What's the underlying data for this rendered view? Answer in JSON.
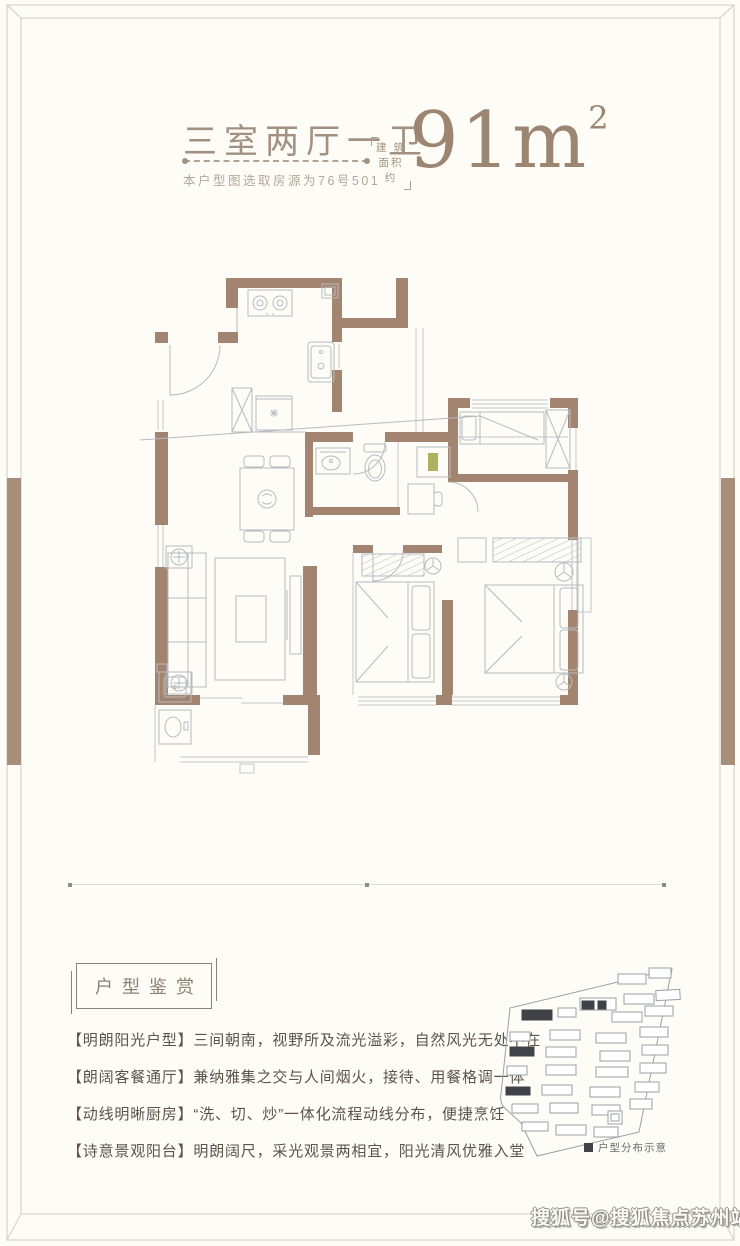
{
  "page": {
    "background": "#fdfcf7",
    "frame_color": "#d8d4ca",
    "accent_color": "#a68e7a"
  },
  "header": {
    "title": "三室两厅一卫",
    "subtitle": "本户型图选取房源为76号501",
    "area_prefix_line1": "建 筑",
    "area_prefix_line2": "面积约",
    "area_value": "91m",
    "area_superscript": "2"
  },
  "floor_plan": {
    "wall_color": "#a28470",
    "furniture_line_color": "#b7bbc0",
    "fixture_icons": [
      "stove-icon",
      "kitchen-sink-icon",
      "fridge-icon",
      "dining-table-icon",
      "washbasin-icon",
      "toilet-icon",
      "bed-icon",
      "wardrobe-icon",
      "sofa-icon",
      "coffee-table-icon",
      "tv-cabinet-icon",
      "washing-machine-icon",
      "laundry-sink-icon",
      "air-conditioner-icon",
      "door-arc-icon",
      "window-icon"
    ]
  },
  "appreciation": {
    "section_title": "户型鉴赏",
    "items": [
      "【明朗阳光户型】三间朝南，视野所及流光溢彩，自然风光无处不在",
      "【朗阔客餐通厅】兼纳雅集之交与人间烟火，接待、用餐格调一体",
      "【动线明晰厨房】“洗、切、炒”一体化流程动线分布，便捷烹饪",
      "【诗意景观阳台】明朗阔尺，采光观景两相宜，阳光清风优雅入堂"
    ]
  },
  "site_map": {
    "legend_label": "户型分布示意",
    "highlight_color": "#3f4247",
    "outline_color": "#9aa0a6"
  },
  "watermark": {
    "text": "搜狐号@搜狐焦点苏州站"
  }
}
